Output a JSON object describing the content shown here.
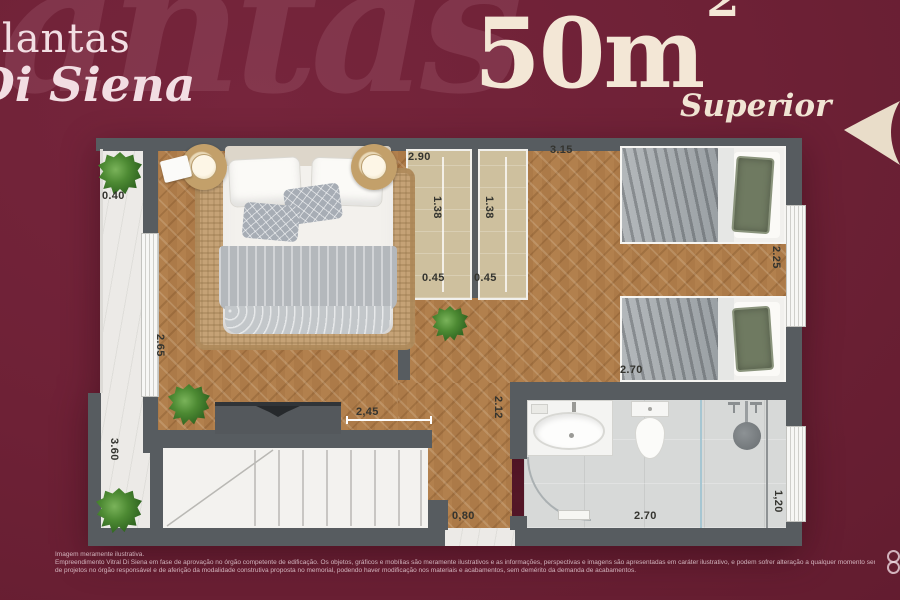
{
  "slide": {
    "watermark": "Plantas",
    "title_line1": "Plantas",
    "title_line2": "Di Siena",
    "area_value": "50m",
    "area_exponent": "2",
    "variant": "Superior",
    "accent_color": "#f3e7d6",
    "background_color": "#6e2136"
  },
  "floorplan": {
    "dims": {
      "balcony_width": "0.40",
      "balcony_length": "3.60",
      "suite_depth": "2.65",
      "closet_run": "2.90",
      "closet_a_depth": "1.38",
      "closet_b_depth": "1.38",
      "closet_a_width": "0.45",
      "closet_b_width": "0.45",
      "bedroom2_width": "3.15",
      "bedroom2_depth": "2.25",
      "bedroom2_length": "2.70",
      "desk_width": "2,45",
      "hall_depth": "2.12",
      "hall_passage": "0,80",
      "bath_width": "2.70",
      "bath_window": "1,20"
    }
  },
  "footer": {
    "line1": "Imagem meramente ilustrativa.",
    "line2": "Empreendimento Vitral Di Siena em fase de aprovação no órgão competente de edificação. Os objetos, gráficos e mobílias são meramente ilustrativos e as informações, perspectivas e imagens são apresentadas em caráter ilustrativo, e podem sofrer alteração a qualquer momento sem aviso prévio, conforme aprovação",
    "line3": "de projetos no órgão responsável e de aferição da modalidade construtiva proposta no memorial, podendo haver modificação nos materiais e acabamentos, sem demérito da demanda de acabamentos."
  }
}
